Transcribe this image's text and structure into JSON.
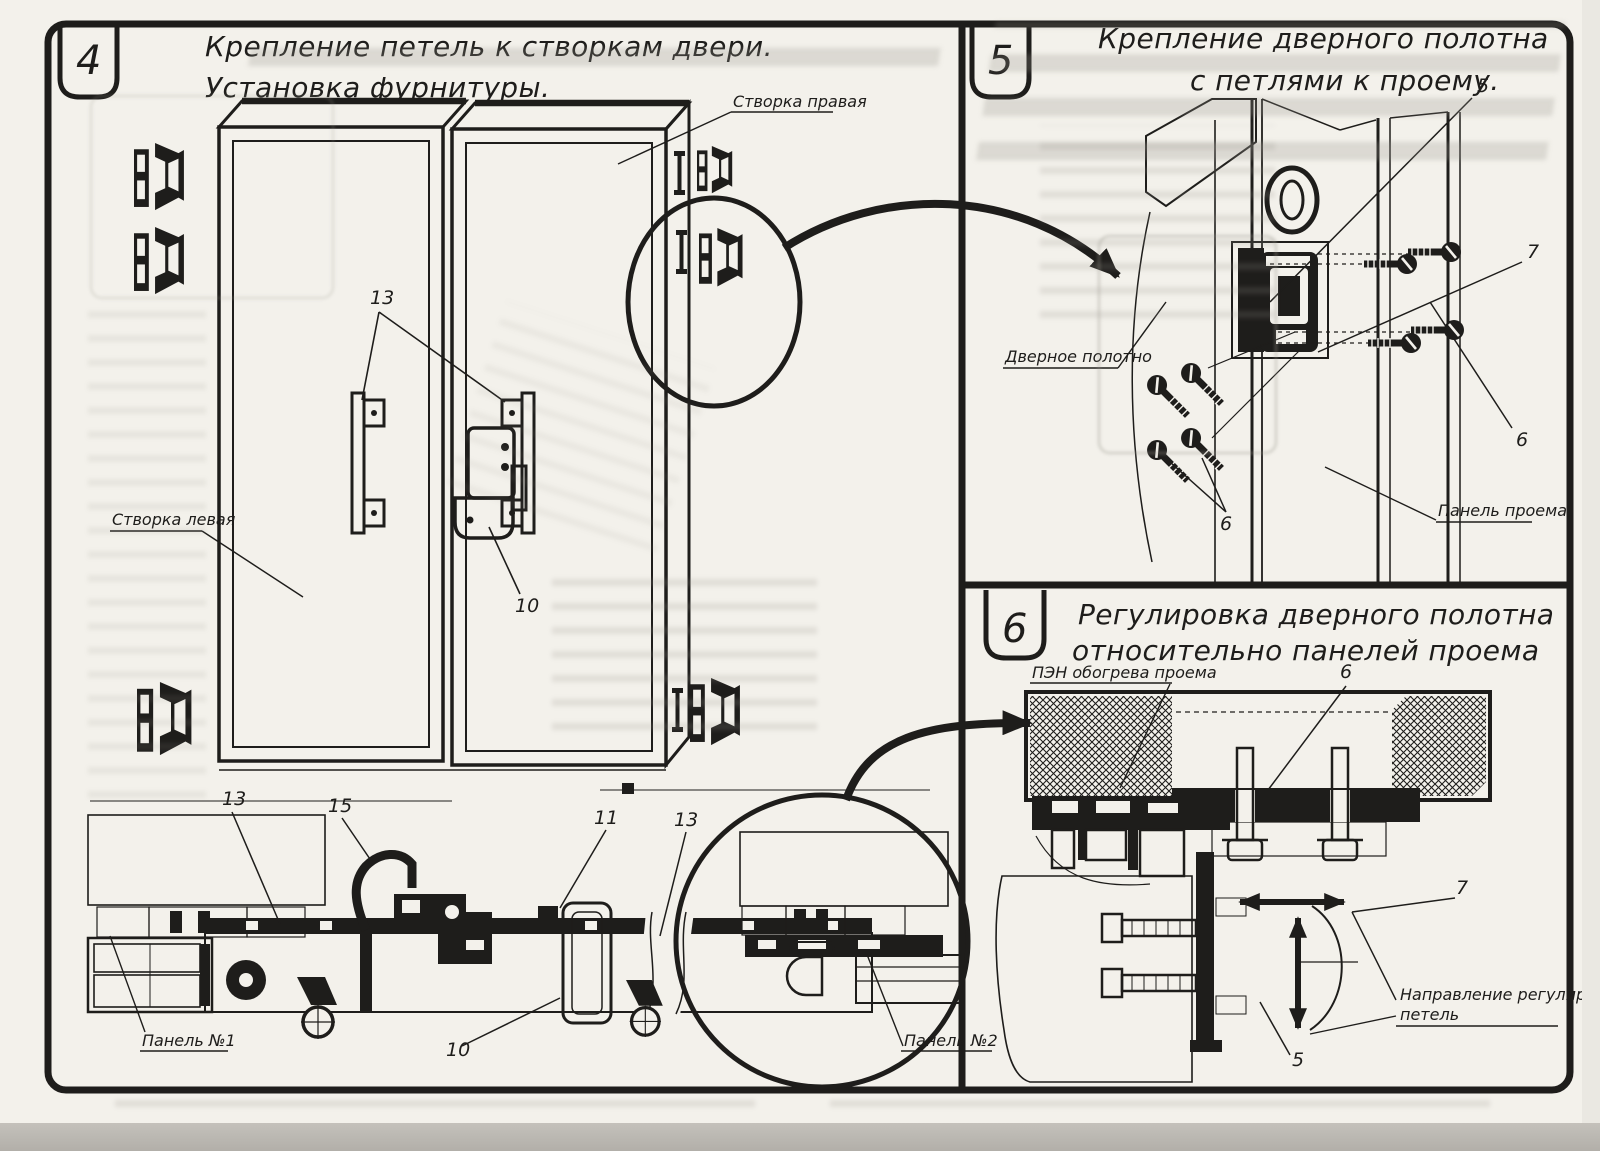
{
  "colors": {
    "ink": "#1e1d1b",
    "paper": "#f3f1eb",
    "ghost": "#c6c3bc",
    "scan_strip": "#b6b3ad"
  },
  "panel4": {
    "number": "4",
    "title1": "Крепление петель к створкам двери.",
    "title2": "Установка фурнитуры.",
    "label_right_leaf": "Створка правая",
    "label_left_leaf": "Створка левая",
    "label_panel1": "Панель №1",
    "label_panel2": "Панель №2",
    "num_13_top": "13",
    "num_10_mid": "10",
    "num_13_left": "13",
    "num_15": "15",
    "num_11": "11",
    "num_13_right": "13",
    "num_10_bottom": "10"
  },
  "panel5": {
    "number": "5",
    "title1": "Крепление дверного полотна",
    "title2": "с петлями к проему.",
    "label_door_leaf": "Дверное полотно",
    "label_opening_panel": "Панель проема",
    "num_5": "5",
    "num_7": "7",
    "num_6_right": "6",
    "num_6_left": "6"
  },
  "panel6": {
    "number": "6",
    "title1": "Регулировка дверного полотна",
    "title2": "относительно панелей проема",
    "label_pen": "ПЭН обогрева проема",
    "label_direction1": "Направление регулировки",
    "label_direction2": "петель",
    "num_6": "6",
    "num_7": "7",
    "num_5": "5"
  }
}
